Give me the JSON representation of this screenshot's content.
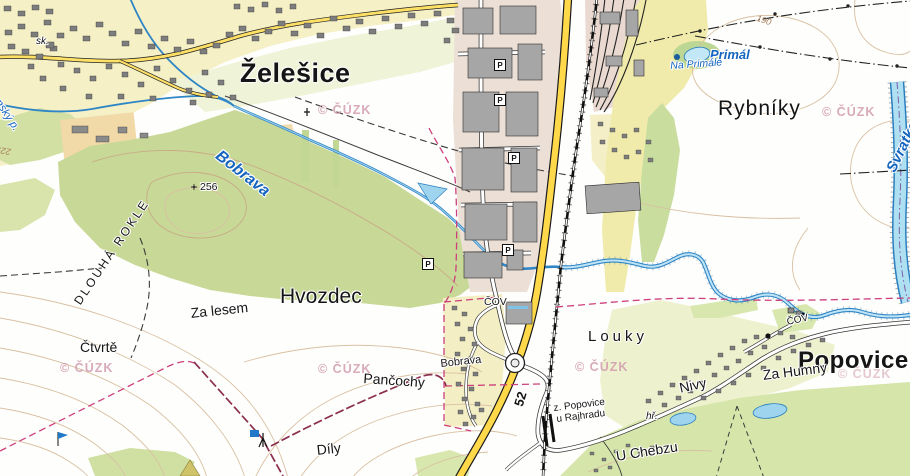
{
  "attribution": "© ČÚZK",
  "places": {
    "towns": {
      "zelesice": "Želešice",
      "popovice": "Popovice"
    },
    "districts": {
      "hvozdec": "Hvozdec",
      "rybniky": "Rybníky",
      "louky": "Louky",
      "za_lesem": "Za lesem",
      "ctvrte": "Čtvrtě",
      "pancochy": "Pančochy",
      "dily": "Díly",
      "u_chebzu": "U Chebzu",
      "za_humny": "Za Humny",
      "nivy": "Nivy",
      "dlouha_rokle": "DLOUHÁ ROKLE",
      "bobrava_village": "Bobrava"
    },
    "waters": {
      "bobrava": "Bobrava",
      "svratka": "Svratka",
      "primal": "Primál",
      "na_primale": "Na Primále",
      "stream_left": "nský p."
    },
    "roads": {
      "route_52": "52"
    },
    "railway": {
      "station_line1": "z. Popovice",
      "station_line2": "u Rajhradu"
    },
    "elevations": {
      "point_256": "256",
      "contour_190": "190",
      "contour_225": "225"
    },
    "misc": {
      "school": "sk.",
      "playground": "hř.",
      "cov": "ČOV",
      "parking": "P"
    }
  },
  "theme": {
    "forest": "#c8d897",
    "meadow": "#d6e6aa",
    "village_ground": "#f5f0c5",
    "industrial_ground": "#ebdfd6",
    "water_line": "#2f86c6",
    "water_fill": "#bfe4f6",
    "highway": "#ffd94a",
    "contour": "#d9c0a3",
    "boundary_magenta": "#cd3f7d",
    "building_gray": "#7d7d7d",
    "watermark_pink": "#d29cb0"
  }
}
